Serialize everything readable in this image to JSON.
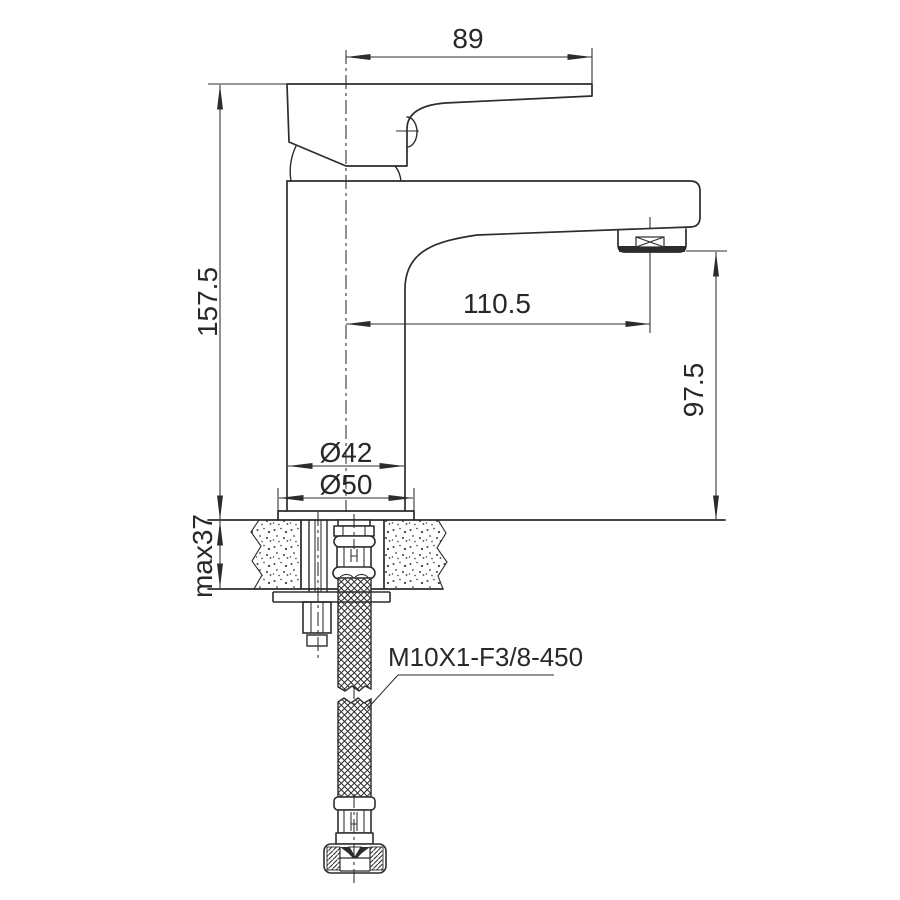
{
  "page": {
    "background": "#ffffff"
  },
  "drawing": {
    "line_color": "#2c2c2c",
    "text_color": "#282828",
    "labels": {
      "handle_length": "89",
      "overall_height": "157.5",
      "spout_reach": "110.5",
      "outlet_height": "97.5",
      "body_diameter": "Ø42",
      "base_diameter": "Ø50",
      "max_mounting_thickness": "max37",
      "supply_hose_spec": "M10X1-F3/8-450"
    }
  }
}
